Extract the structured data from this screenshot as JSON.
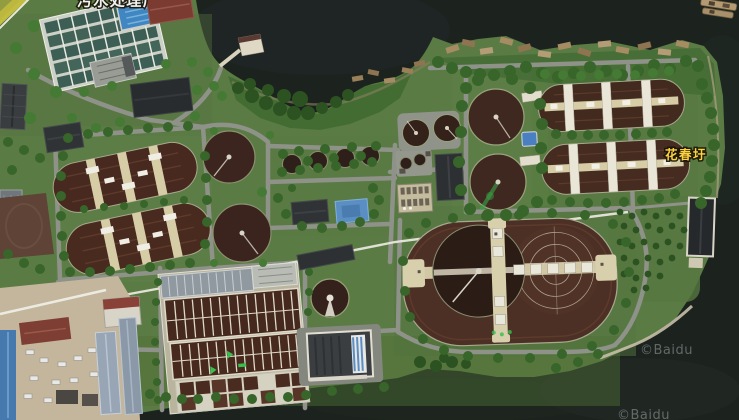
{
  "map": {
    "type": "satellite-imagery",
    "scene": "wastewater-treatment-plant-on-river-peninsula",
    "labels": {
      "top_place": "污水处理厂",
      "right_place": "花春圩",
      "watermark_a": "©Baidu",
      "watermark_b": "©Baidu"
    },
    "palette": {
      "water": "#1c231f",
      "land_green": "#5b7b44",
      "tree_green": "#38652a",
      "basin_brown": "#46291e",
      "road_gray": "#8f9289",
      "walkway_tan": "#d8d0ac",
      "label_top_fill": "#f2f2f2",
      "label_place_fill": "#ffd23e",
      "watermark_fill": "#99a1a1"
    },
    "features": [
      "oxidation-ditch-basins",
      "circular-clarifier-tanks",
      "aeration-lane-basins",
      "plant-buildings",
      "river-water",
      "tree-rows"
    ]
  }
}
